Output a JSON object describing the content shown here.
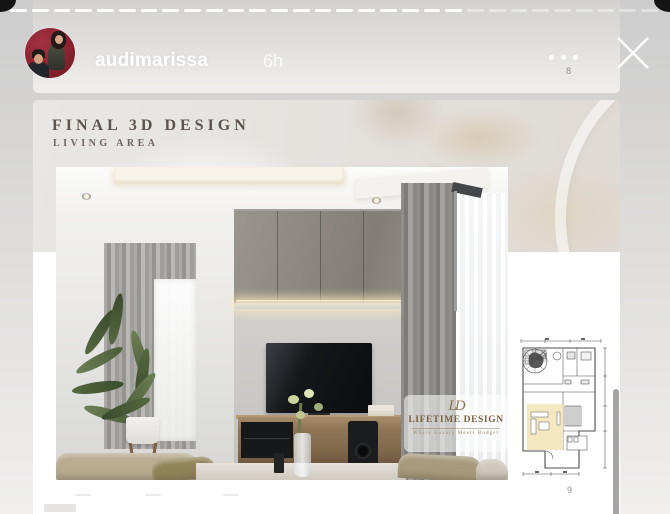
{
  "story": {
    "username": "audimarissa",
    "timestamp": "6h",
    "progress": {
      "total": 30,
      "viewed": 21
    },
    "more_options": "more-options",
    "close": "close"
  },
  "previous_slide": {
    "page_number": "8"
  },
  "slide": {
    "header": {
      "title": "FINAL 3D DESIGN",
      "subtitle": "LIVING AREA"
    },
    "watermark": {
      "monogram": "LD",
      "name": "LIFETIME DESIGN",
      "tagline": "Where Luxury Meets Budget"
    },
    "page_number": "9"
  },
  "colors": {
    "background_gray": "#d6d5d4",
    "card_white": "#ffffff",
    "progress_viewed": "#f7f7f7",
    "logo_bronze": "#8d7350",
    "plan_highlight": "#f5e8c0",
    "avatar_red": "#8a222f"
  }
}
